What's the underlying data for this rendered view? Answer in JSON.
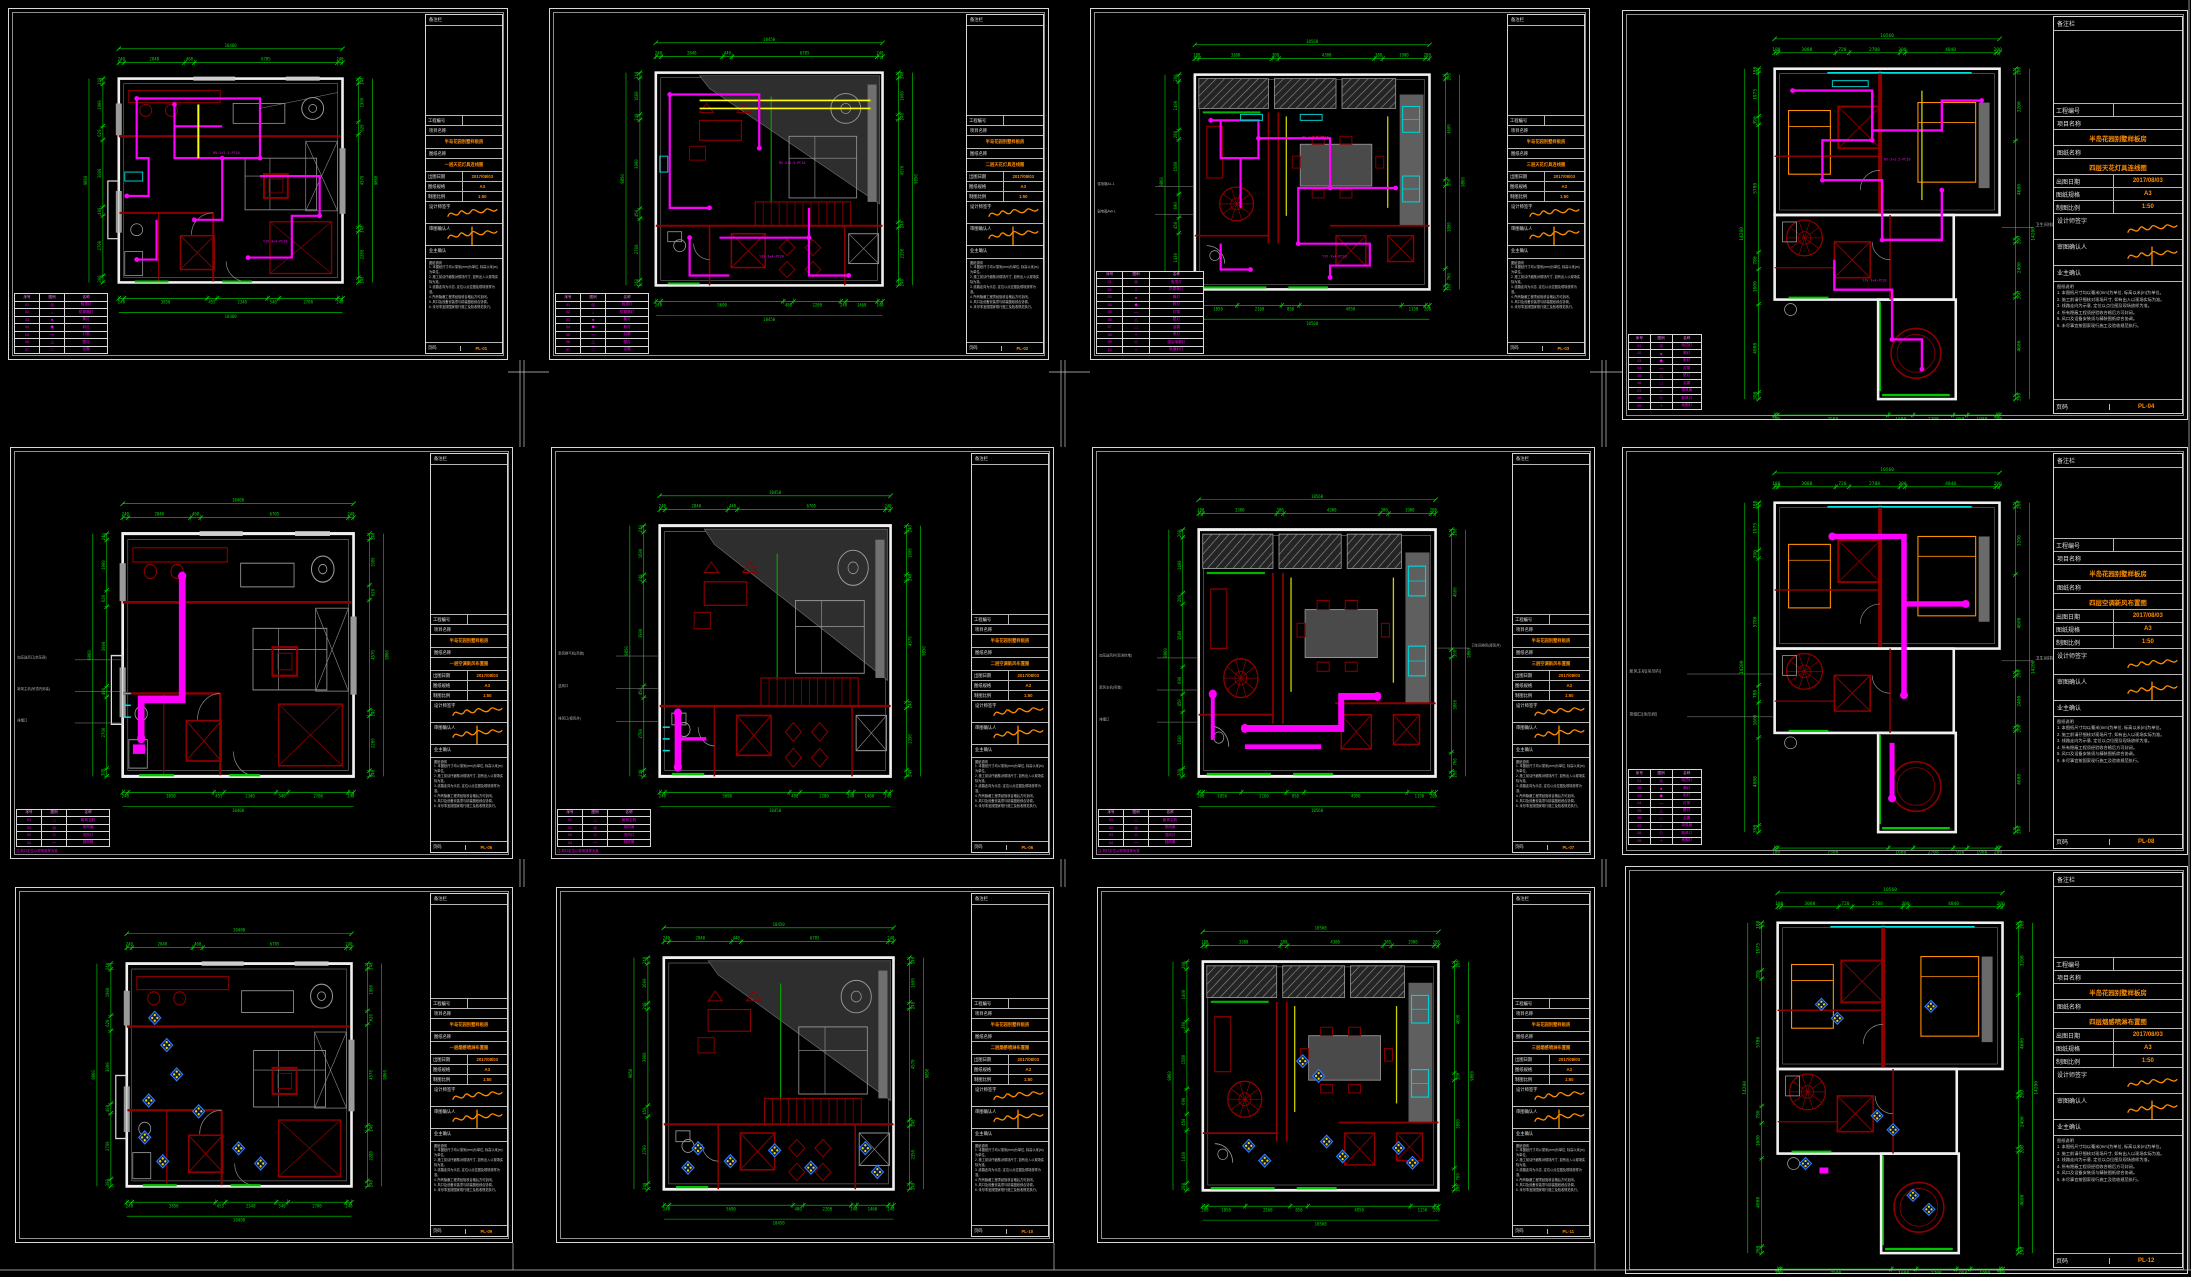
{
  "canvas": {
    "width": 2191,
    "height": 1277,
    "background": "#000000"
  },
  "colors": {
    "wiring_magenta": "#ff00ff",
    "wall_red": "#8c0000",
    "dim_green": "#00dc00",
    "accent_orange": "#ff8c00",
    "trace_yellow": "#ffff00",
    "fixture_cyan": "#00cccc",
    "detector_blue": "#2b7bff",
    "sheet_border": "#d8d8d8",
    "bed_orange": "#ff9000"
  },
  "titleblock": {
    "header": "备注栏",
    "labels": {
      "no": "工程编号",
      "project": "项目名称",
      "drawing": "图纸名称",
      "date": "出图日期",
      "spec": "图纸规格",
      "scale": "制图比例",
      "design": "设计师签字",
      "check": "审图确认人",
      "owner": "业主确认"
    },
    "project": "半岛花园别墅样板房",
    "date": "2017/08/03",
    "spec": "A3",
    "scale": "1:50",
    "notes_title": "图纸说明",
    "page_label": "页码",
    "notes": [
      "1. 本图纸尺寸均以毫米(mm)为单位, 标高以米(m)为单位。",
      "2. 施工前请仔细核对现场尺寸, 如有出入以现场实际为准。",
      "3. 线路走向为示意, 定位以点位图及现场放样为准。",
      "4. 所有隐蔽工程须经验收合格后方可封闭。",
      "5. 风口及设备安装须与精装图纸综合协调。",
      "6. 未尽事宜按国家现行施工及验收规范执行。"
    ]
  },
  "legend": {
    "headers": [
      "序号",
      "图例",
      "名称"
    ],
    "footnote": "注:风口定位以现场放样为准"
  },
  "legend_sets": {
    "L7": [
      [
        "01",
        "◎",
        "吸顶灯"
      ],
      [
        "02",
        "○",
        "防雾筒灯"
      ],
      [
        "03",
        "●",
        "筒灯"
      ],
      [
        "04",
        "◆",
        "射灯"
      ],
      [
        "05",
        "—",
        "灯带"
      ],
      [
        "06",
        "△",
        "壁灯"
      ],
      [
        "07",
        "□",
        "浴霸"
      ]
    ],
    "L10": [
      [
        "01",
        "◎",
        "吸顶灯"
      ],
      [
        "02",
        "○",
        "防雾筒灯"
      ],
      [
        "03",
        "●",
        "筒灯"
      ],
      [
        "04",
        "◆",
        "射灯"
      ],
      [
        "05",
        "—",
        "灯带"
      ],
      [
        "06",
        "△",
        "壁灯"
      ],
      [
        "07",
        "□",
        "浴霸"
      ],
      [
        "08",
        "+",
        "吊灯"
      ],
      [
        "09",
        "◇",
        "感应地脚灯"
      ],
      [
        "10",
        "○",
        "轨道射灯"
      ]
    ],
    "L4": [
      [
        "01",
        "□",
        "新风主机"
      ],
      [
        "02",
        "◎",
        "排风扇"
      ],
      [
        "03",
        "◇",
        "送风口"
      ],
      [
        "04",
        "—",
        "回风管"
      ]
    ],
    "L9": [
      [
        "01",
        "◎",
        "吸顶灯"
      ],
      [
        "02",
        "●",
        "筒灯"
      ],
      [
        "03",
        "◆",
        "射灯"
      ],
      [
        "04",
        "—",
        "灯带"
      ],
      [
        "05",
        "△",
        "壁灯"
      ],
      [
        "06",
        "□",
        "浴霸"
      ],
      [
        "07",
        "○",
        "排风扇"
      ],
      [
        "08",
        "◇",
        "新风口"
      ],
      [
        "09",
        "+",
        "地脚灯"
      ]
    ]
  },
  "wire_labels": [
    "BV-2×2.5-PC16",
    "YJV-3×4-PC20"
  ],
  "dim_sets": {
    "A": {
      "top": {
        "segs": [
          240,
          2840,
          460,
          6705,
          240
        ],
        "total": "10400"
      },
      "bottom": {
        "segs": [
          240,
          3850,
          455,
          2340,
          540,
          2700,
          240
        ],
        "total": "10400"
      },
      "left": {
        "segs": [
          240,
          1900,
          620,
          3000,
          400,
          2700,
          300
        ],
        "total": "9860"
      },
      "right": {
        "segs": [
          240,
          1900,
          620,
          4570,
          240,
          2280,
          240
        ],
        "total": "9860"
      }
    },
    "B": {
      "top": {
        "segs": [
          240,
          2840,
          440,
          6705,
          240
        ],
        "total": "10450"
      },
      "bottom": {
        "segs": [
          240,
          5690,
          480,
          2200,
          240,
          1460,
          240
        ],
        "total": "10450"
      },
      "left": {
        "segs": [
          240,
          1600,
          240,
          3900,
          450,
          2700,
          240
        ],
        "total": "9850"
      },
      "right": {
        "segs": [
          240,
          1600,
          240,
          4570,
          240,
          2350,
          240
        ],
        "total": "9850"
      }
    },
    "C": {
      "top": {
        "segs": [
          180,
          3300,
          300,
          4300,
          380,
          1900,
          200
        ],
        "total": "10560"
      },
      "bottom": {
        "segs": [
          200,
          1850,
          2160,
          850,
          4950,
          1150,
          200
        ],
        "total": "10560"
      },
      "left": {
        "segs": [
          200,
          1400,
          280,
          1580,
          690,
          450,
          1430,
          200
        ],
        "total": "9860"
      },
      "right": {
        "segs": [
          200,
          4600,
          300,
          3800,
          760,
          200
        ],
        "total": "9860"
      }
    },
    "D": {
      "top": {
        "segs": [
          180,
          3088,
          720,
          2708,
          300,
          4840,
          200
        ],
        "total": "10560"
      },
      "bottom": {
        "segs": [
          180,
          7508,
          1680,
          2708,
          950,
          1980,
          200
        ],
        "total": "10520"
      },
      "left": {
        "segs": [
          180,
          1975,
          390,
          5780,
          780,
          1600,
          4008,
          300
        ],
        "total": "14200"
      },
      "right": {
        "segs": [
          200,
          3200,
          4600,
          200,
          2400,
          200,
          4600,
          200
        ],
        "total": "14200"
      }
    }
  },
  "sheets": [
    {
      "title": "一层天花灯具连线图",
      "page": "PL-01",
      "legend": "L7",
      "dims": "A",
      "leaders_left": [],
      "leaders_right": []
    },
    {
      "title": "二层天花灯具连线图",
      "page": "PL-02",
      "legend": "L7",
      "dims": "B",
      "leaders_left": [],
      "leaders_right": []
    },
    {
      "title": "三层天花灯具连线图",
      "page": "PL-03",
      "legend": "L10",
      "dims": "C",
      "leaders_left": [
        "强电箱AL-1",
        "弱电箱AW-1"
      ],
      "leaders_right": []
    },
    {
      "title": "四层天花灯具连线图",
      "page": "PL-04",
      "legend": "L9",
      "dims": "D",
      "leaders_left": [],
      "leaders_right": [
        "卫生间排风(接风井)"
      ]
    },
    {
      "title": "一层空调新风布置图",
      "page": "PL-05",
      "legend": "L4",
      "dims": "A",
      "leaders_left": [
        "加压送风口(余压阀)",
        "新风主机(吊顶内安装)",
        "排烟口"
      ],
      "leaders_right": []
    },
    {
      "title": "二层空调新风布置图",
      "page": "PL-06",
      "legend": "L4",
      "dims": "B",
      "leaders_left": [
        "新风换气机(吊装)",
        "送风口",
        "排风口(接风井)"
      ],
      "leaders_right": []
    },
    {
      "title": "三层空调新风布置图",
      "page": "PL-07",
      "legend": "L4",
      "dims": "C",
      "leaders_left": [
        "加压送风井(现浇封堵)",
        "新风主机(吊装)",
        "排烟口"
      ],
      "leaders_right": [
        "卫生间排风(接风井)"
      ]
    },
    {
      "title": "四层空调新风布置图",
      "page": "PL-08",
      "legend": "L9",
      "dims": "D",
      "leaders_left": [
        "新风主机(吊顶内)",
        "排烟口(余压阀)"
      ],
      "leaders_right": [
        "卫生间排风(接风井)"
      ]
    },
    {
      "title": "一层烟感喷淋布置图",
      "page": "PL-09",
      "legend": null,
      "dims": "A",
      "leaders_left": [],
      "leaders_right": []
    },
    {
      "title": "二层烟感喷淋布置图",
      "page": "PL-10",
      "legend": null,
      "dims": "B",
      "leaders_left": [],
      "leaders_right": []
    },
    {
      "title": "三层烟感喷淋布置图",
      "page": "PL-11",
      "legend": null,
      "dims": "C",
      "leaders_left": [],
      "leaders_right": []
    },
    {
      "title": "四层烟感喷淋布置图",
      "page": "PL-12",
      "legend": null,
      "dims": "D",
      "leaders_left": [],
      "leaders_right": []
    }
  ]
}
